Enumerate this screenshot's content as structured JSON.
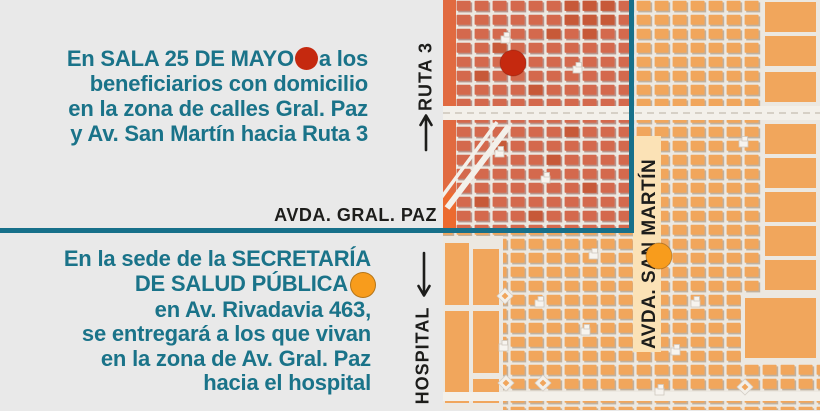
{
  "colors": {
    "teal_text": "#1a7389",
    "teal_line": "#17708a",
    "panel_background": "#e9e9e9",
    "red_marker": "#c5290f",
    "orange_marker": "#f89c1c",
    "red_zone_block": "#d4694d",
    "orange_zone_block": "#f1a65c",
    "street_label_band": "#fbe2b6"
  },
  "sala_notice": {
    "line1_before_marker": "En SALA 25 DE MAYO",
    "line1_after_marker": "a los",
    "line2": "beneficiarios con domicilio",
    "line3": "en la zona de calles Gral. Paz",
    "line4": "y Av. San Martín hacia Ruta 3"
  },
  "secretaria_notice": {
    "line1": "En la sede de la SECRETARÍA",
    "line2_before_marker": "DE SALUD PÚBLICA",
    "line3": "en Av. Rivadavia 463,",
    "line4": "se entregará a los que vivan",
    "line5": "en la zona de Av. Gral. Paz",
    "line6": "hacia el hospital"
  },
  "streets": {
    "gral_paz": "AVDA. GRAL. PAZ",
    "ruta3": "RUTA 3",
    "hospital": "HOSPITAL",
    "san_martin": "AVDA. SAN MARTÍN"
  }
}
